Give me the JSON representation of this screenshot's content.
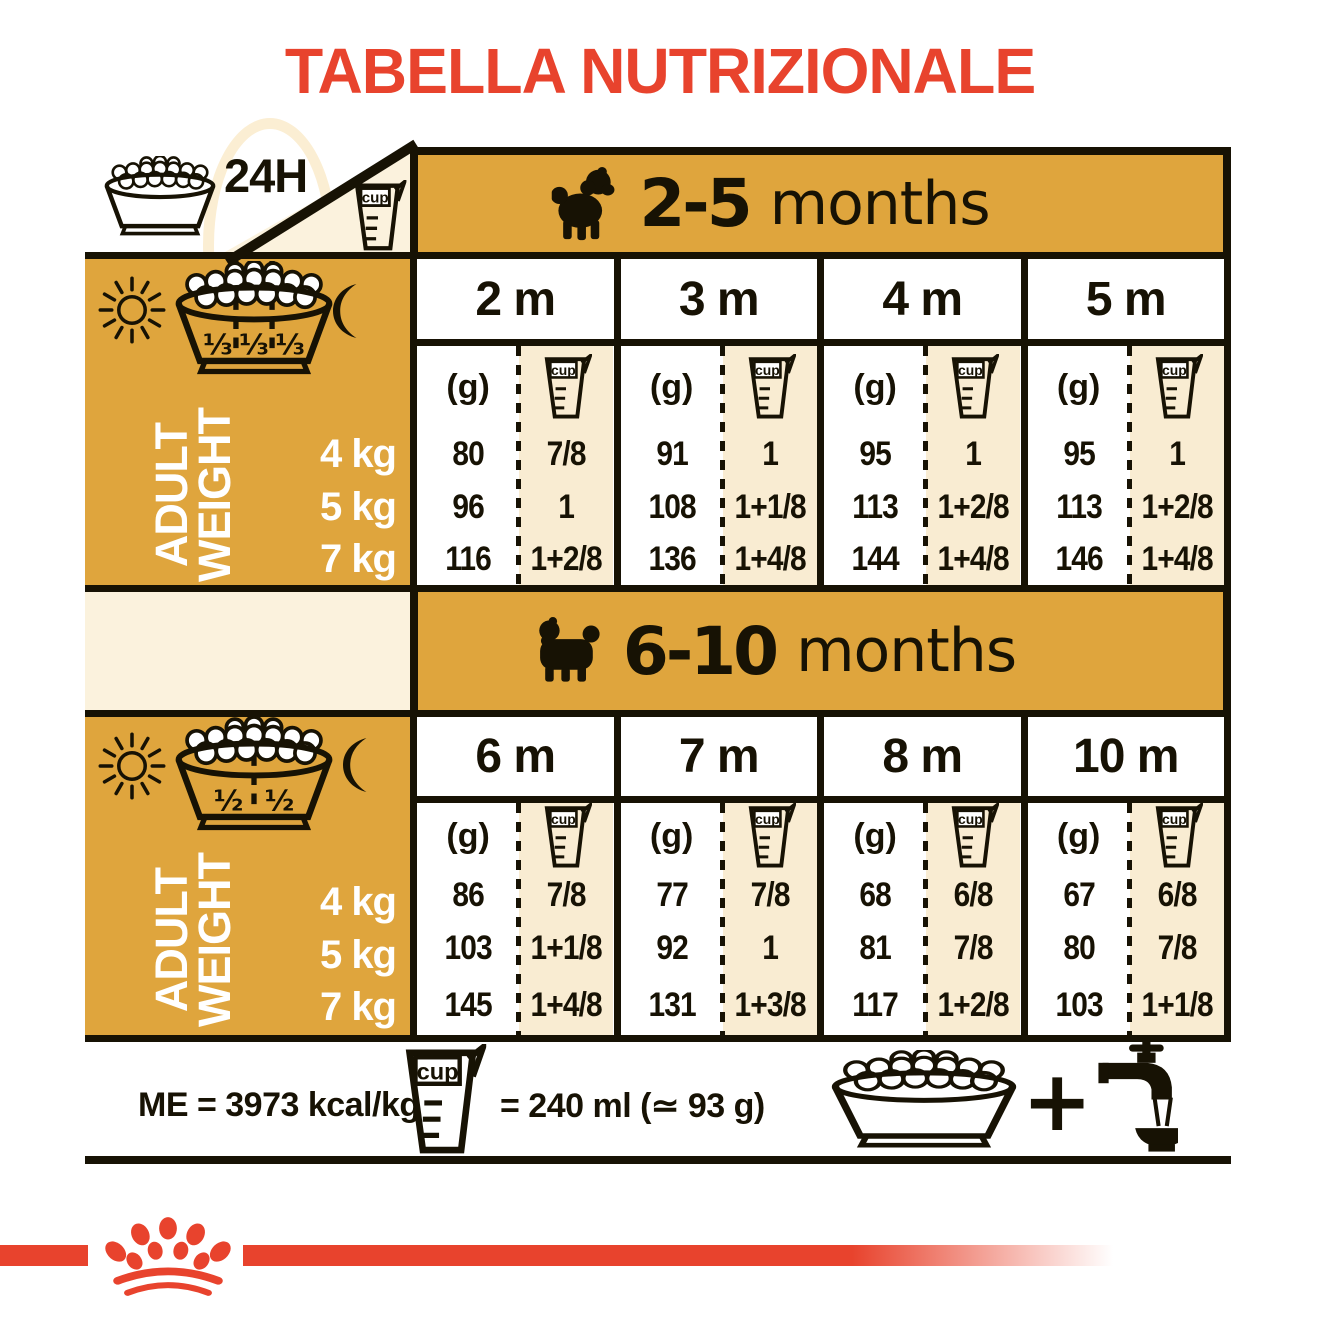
{
  "header": {
    "title": "TABELLA NUTRIZIONALE",
    "hours_label": "24H"
  },
  "colors": {
    "accent_red": "#e8432d",
    "gold": "#dfa53d",
    "cream": "#f9ecd2",
    "cream_light": "#fbf2dd",
    "ink": "#171204"
  },
  "icons": {
    "cup_label": "cup",
    "names": [
      "kibble-bowl-icon",
      "measuring-cup-icon",
      "sun-icon",
      "moon-icon",
      "puppy-silhouette-icon",
      "adult-dog-silhouette-icon",
      "water-tap-icon",
      "plus-icon",
      "royal-canin-crown-icon",
      "24h-bowl-icon"
    ]
  },
  "sections": [
    {
      "age_bold": "2-5",
      "age_rest": "months",
      "dog_icon": "puppy-silhouette",
      "bowl_fractions": [
        "⅓",
        "⅓",
        "⅓"
      ],
      "adult_weight_label": [
        "ADULT",
        "WEIGHT"
      ],
      "weights": [
        "4 kg",
        "5 kg",
        "7 kg"
      ],
      "grams_unit": "(g)",
      "columns": [
        {
          "month": "2 m",
          "grams": [
            "80",
            "96",
            "116"
          ],
          "cups": [
            "7/8",
            "1",
            "1+2/8"
          ]
        },
        {
          "month": "3 m",
          "grams": [
            "91",
            "108",
            "136"
          ],
          "cups": [
            "1",
            "1+1/8",
            "1+4/8"
          ]
        },
        {
          "month": "4 m",
          "grams": [
            "95",
            "113",
            "144"
          ],
          "cups": [
            "1",
            "1+2/8",
            "1+4/8"
          ]
        },
        {
          "month": "5 m",
          "grams": [
            "95",
            "113",
            "146"
          ],
          "cups": [
            "1",
            "1+2/8",
            "1+4/8"
          ]
        }
      ]
    },
    {
      "age_bold": "6-10",
      "age_rest": "months",
      "dog_icon": "adult-dog-silhouette",
      "bowl_fractions": [
        "½",
        "½"
      ],
      "adult_weight_label": [
        "ADULT",
        "WEIGHT"
      ],
      "weights": [
        "4 kg",
        "5 kg",
        "7 kg"
      ],
      "grams_unit": "(g)",
      "columns": [
        {
          "month": "6 m",
          "grams": [
            "86",
            "103",
            "145"
          ],
          "cups": [
            "7/8",
            "1+1/8",
            "1+4/8"
          ]
        },
        {
          "month": "7 m",
          "grams": [
            "77",
            "92",
            "131"
          ],
          "cups": [
            "7/8",
            "1",
            "1+3/8"
          ]
        },
        {
          "month": "8 m",
          "grams": [
            "68",
            "81",
            "117"
          ],
          "cups": [
            "6/8",
            "7/8",
            "1+2/8"
          ]
        },
        {
          "month": "10 m",
          "grams": [
            "67",
            "80",
            "103"
          ],
          "cups": [
            "6/8",
            "7/8",
            "1+1/8"
          ]
        }
      ]
    }
  ],
  "footer": {
    "me_label": "ME = 3973 kcal/kg",
    "cup_equivalence": "= 240 ml (≃ 93 g)",
    "plus": "+"
  }
}
